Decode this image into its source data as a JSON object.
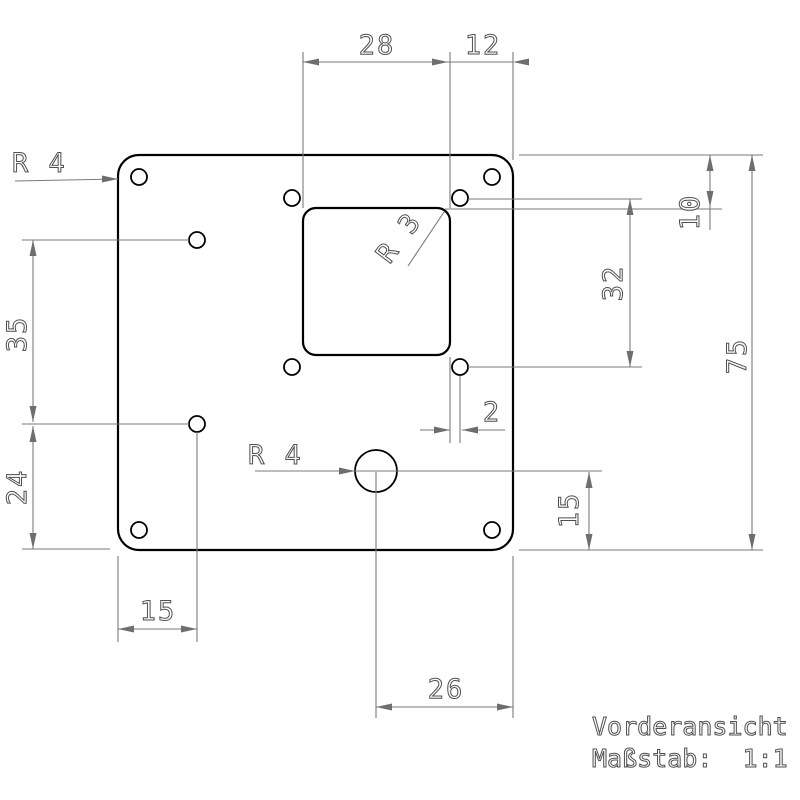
{
  "drawing": {
    "view_name": "Vorderansicht",
    "scale_label": "Maßstab:  1:1",
    "dimensions": {
      "cutout_width": "28",
      "cutout_to_right_edge": "12",
      "top_edge_to_cutout": "10",
      "hole_pattern_height": "32",
      "plate_height": "75",
      "left_holes_spacing": "35",
      "lower_left_hole_height": "24",
      "left_edge_to_holes": "15",
      "cutout_to_hole_gap": "2",
      "center_hole_height": "15",
      "center_hole_to_right_edge": "26",
      "corner_radius": "R 4",
      "center_hole_radius": "R 4",
      "cutout_corner_radius": "R 3"
    },
    "colors": {
      "part_line": "#000000",
      "dimension_line": "#7a7a7a"
    }
  }
}
